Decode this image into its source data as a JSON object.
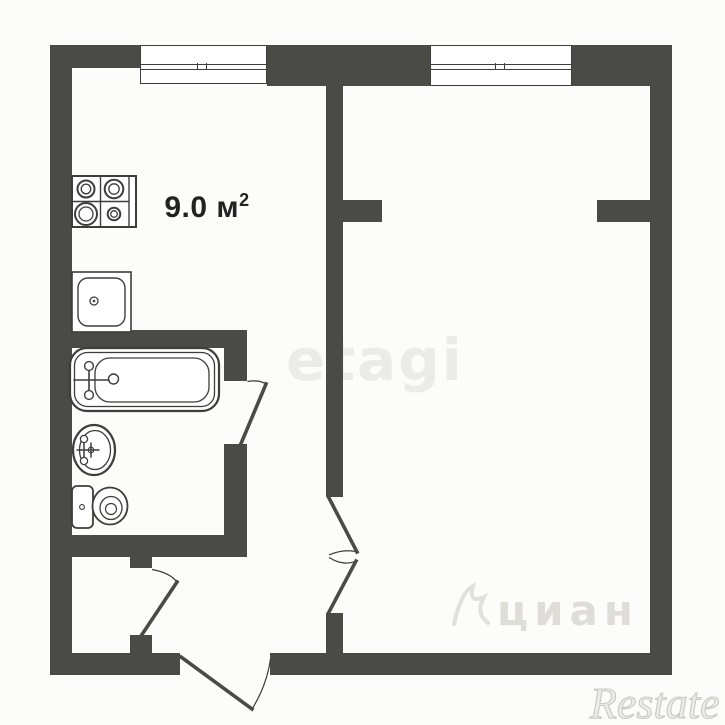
{
  "plan": {
    "colors": {
      "wall": "#4a4a47",
      "line": "#3d3d3b",
      "bg": "#fcfcfb",
      "label": "#222222",
      "wm-etagi": "#ebebea",
      "wm-cian": "rgba(188,183,174,0.45)",
      "wm-restate": "#c9c9c6"
    }
  },
  "rooms": {
    "kitchen": {
      "area_text": "9.0 м",
      "area_sup": "2"
    }
  },
  "fixtures": {
    "stove": "stove-icon",
    "kitchen_sink": "kitchen-sink-icon",
    "bathtub": "bathtub-icon",
    "washbasin": "washbasin-icon",
    "toilet": "toilet-icon",
    "window_kitchen": "window-icon",
    "window_room": "window-icon",
    "door_bathroom": "door-swing-icon",
    "door_closet": "door-swing-icon",
    "door_room_double": "double-door-swing-icon",
    "door_entry": "door-swing-icon"
  },
  "watermarks": {
    "etagi": "etagi",
    "cian": "циан",
    "restate": "Restate"
  }
}
